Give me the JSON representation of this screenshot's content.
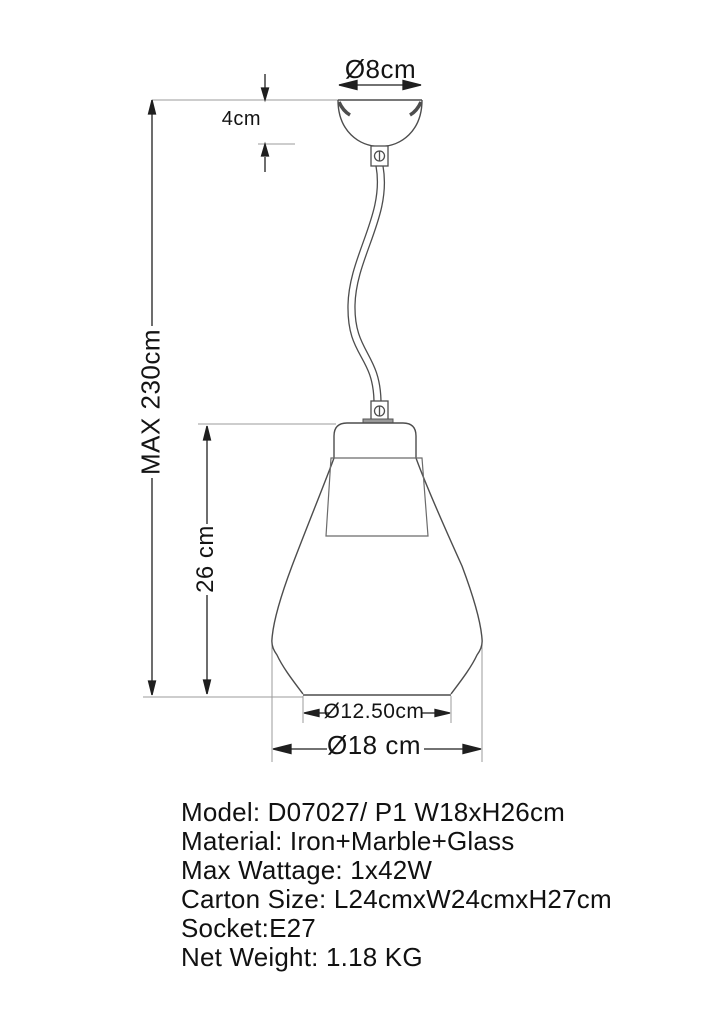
{
  "drawing": {
    "title": "pendant-lamp-dimension-drawing",
    "labels": {
      "canopy_diameter": "Ø8cm",
      "canopy_height": "4cm",
      "max_height": "MAX 230cm",
      "shade_height": "26 cm",
      "opening_diameter": "Ø12.50cm",
      "shade_diameter": "Ø18 cm"
    }
  },
  "specs": {
    "lines": [
      "Model: D07027/ P1 W18xH26cm",
      "Material: Iron+Marble+Glass",
      "Max Wattage: 1x42W",
      "Carton Size: L24cmxW24cmxH27cm",
      "Socket:E27",
      "Net Weight: 1.18 KG"
    ]
  },
  "colors": {
    "background": "#ffffff",
    "outline": "#4d4d4d",
    "inner_shade_line": "#6b6b6b",
    "dimension_line": "#1f1f1f",
    "extension_line": "#9b9b9b",
    "text": "#141414"
  }
}
